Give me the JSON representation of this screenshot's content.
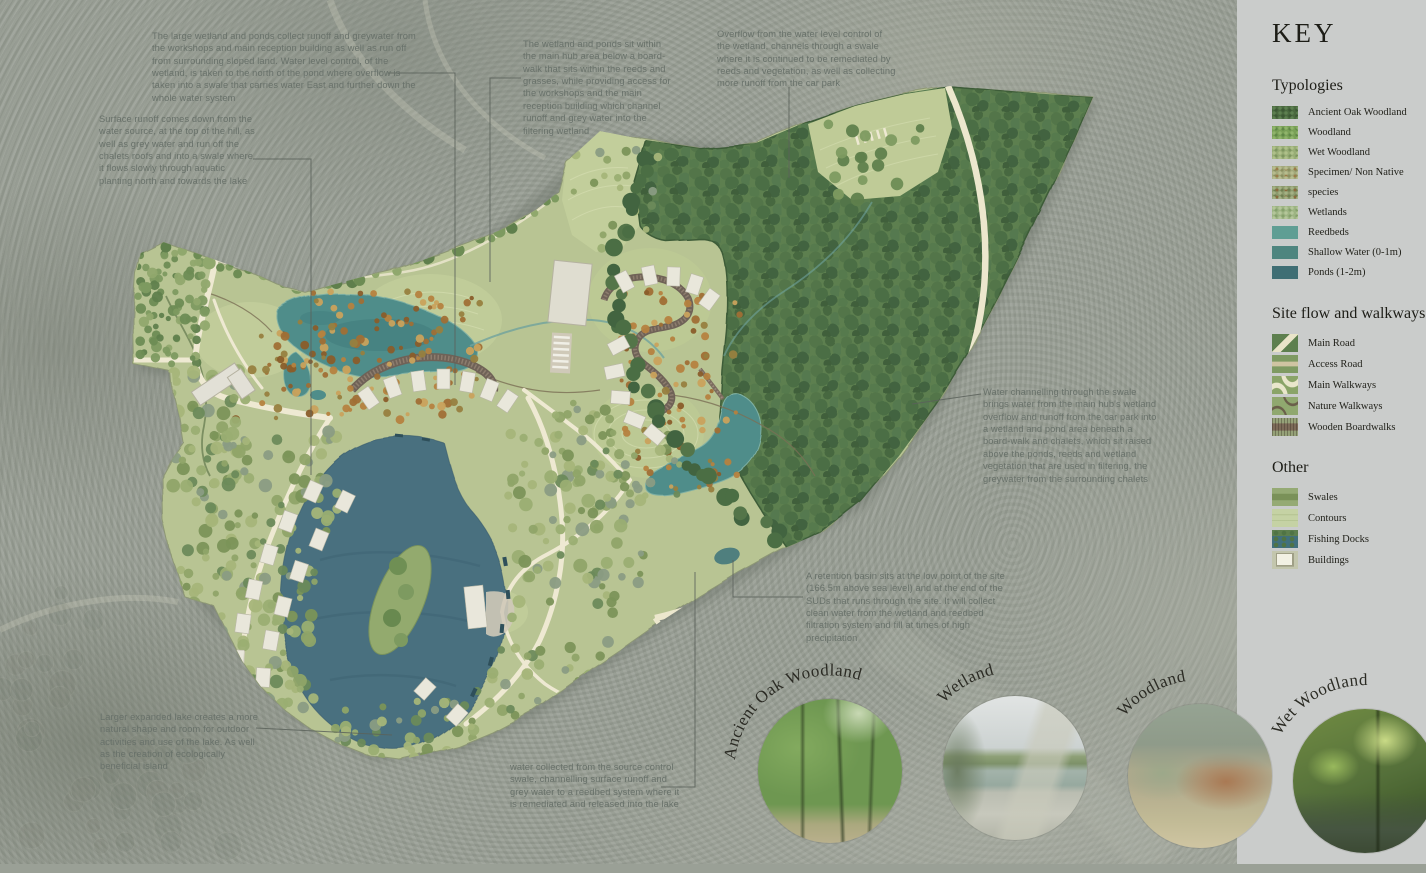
{
  "key_panel": {
    "title": "KEY",
    "sections": [
      {
        "title": "Typologies",
        "items": [
          {
            "label": "Ancient Oak Woodland",
            "swatch": "ancient-oak-woodland"
          },
          {
            "label": "Woodland",
            "swatch": "woodland"
          },
          {
            "label": "Wet Woodland",
            "swatch": "wet-woodland"
          },
          {
            "label": "Specimen/ Non Native",
            "swatch": "specimen-non-native"
          },
          {
            "label": "species",
            "swatch": "species"
          },
          {
            "label": "Wetlands",
            "swatch": "wetlands"
          },
          {
            "label": "Reedbeds",
            "swatch": "reedbeds"
          },
          {
            "label": "Shallow Water (0-1m)",
            "swatch": "shallow-water"
          },
          {
            "label": "Ponds (1-2m)",
            "swatch": "ponds"
          }
        ]
      },
      {
        "title": "Site flow and walkways",
        "items": [
          {
            "label": "Main Road",
            "swatch": "main-road"
          },
          {
            "label": "Access Road",
            "swatch": "access-road"
          },
          {
            "label": "Main Walkways",
            "swatch": "main-walkways"
          },
          {
            "label": "Nature Walkways",
            "swatch": "nature-walkways"
          },
          {
            "label": "Wooden Boardwalks",
            "swatch": "wooden-boardwalks"
          }
        ]
      },
      {
        "title": "Other",
        "items": [
          {
            "label": "Swales",
            "swatch": "swales"
          },
          {
            "label": "Contours",
            "swatch": "contours"
          },
          {
            "label": "Fishing Docks",
            "swatch": "fishing-docks"
          },
          {
            "label": "Buildings",
            "swatch": "buildings"
          }
        ]
      }
    ]
  },
  "annotations": {
    "large_wetland": "The large wetland and ponds collect runoff and greywater from the workshops and main reception building as well as run off from surrounding sloped land. Water level control, of the wetland, is taken to the north of the pond where overflow is taken into a swale that carries water East and further down the whole water system",
    "surface_runoff": "Surface runoff comes down from the water source, at the top of the hill, as well as grey water and run off the chalets roofs and into a swale where it flows slowly through aquatic planting north and towards the lake",
    "hub_boardwalk": "The wetland and ponds sit within the main hub area below a board-walk that sits within the reeds and grasses, while providing access for the workshops and the main reception building which channel runoff and grey water into the filtering wetland",
    "overflow_swale": "Overflow from the water level control of the wetland, channels through a swale where it is continued to be remediated by reeds and vegetation, as well as collecting more runoff from the car park",
    "swale_channelling": "Water channelling through the swale brings water from the main hub's wetland overflow and runoff from the car park into a wetland and pond area beneath a board-walk and chalets, which sit raised above the ponds, reeds and wetland vegetation that are used in filtering. the greywater from the surrounding chalets",
    "retention_basin": "A retention basin sits at the low point of the site (166.5m above sea level) and at the end of the SUDs that runs through the site. It will collect clean water from the wetland and reedbed filtration system and fill at times of high precipitation",
    "larger_lake": "Larger expanded lake creates a more natural shape and room for outdoor activities and use of the lake. As well as the creation of ecologically beneficial island",
    "water_collected": "water collected from the source control swale, channelling surface runoff and grey water to a reedbed system where it is remediated and released into the lake"
  },
  "photos": [
    {
      "label": "Ancient Oak Woodland",
      "icon": "ancient-oak-woodland-photo"
    },
    {
      "label": "Wetland",
      "icon": "wetland-photo"
    },
    {
      "label": "Woodland",
      "icon": "woodland-photo"
    },
    {
      "label": "Wet Woodland",
      "icon": "wet-woodland-photo"
    }
  ],
  "colors": {
    "panel": "#cacccb",
    "aerial": "#9aa096",
    "site_grass": "#b8c493",
    "woodland": "#5d7f4f",
    "wetland": "#4f8d8a",
    "lake": "#49707f",
    "path": "#eee9d2",
    "boardwalk": "#6f6257",
    "annotation_text": "#68716a"
  }
}
